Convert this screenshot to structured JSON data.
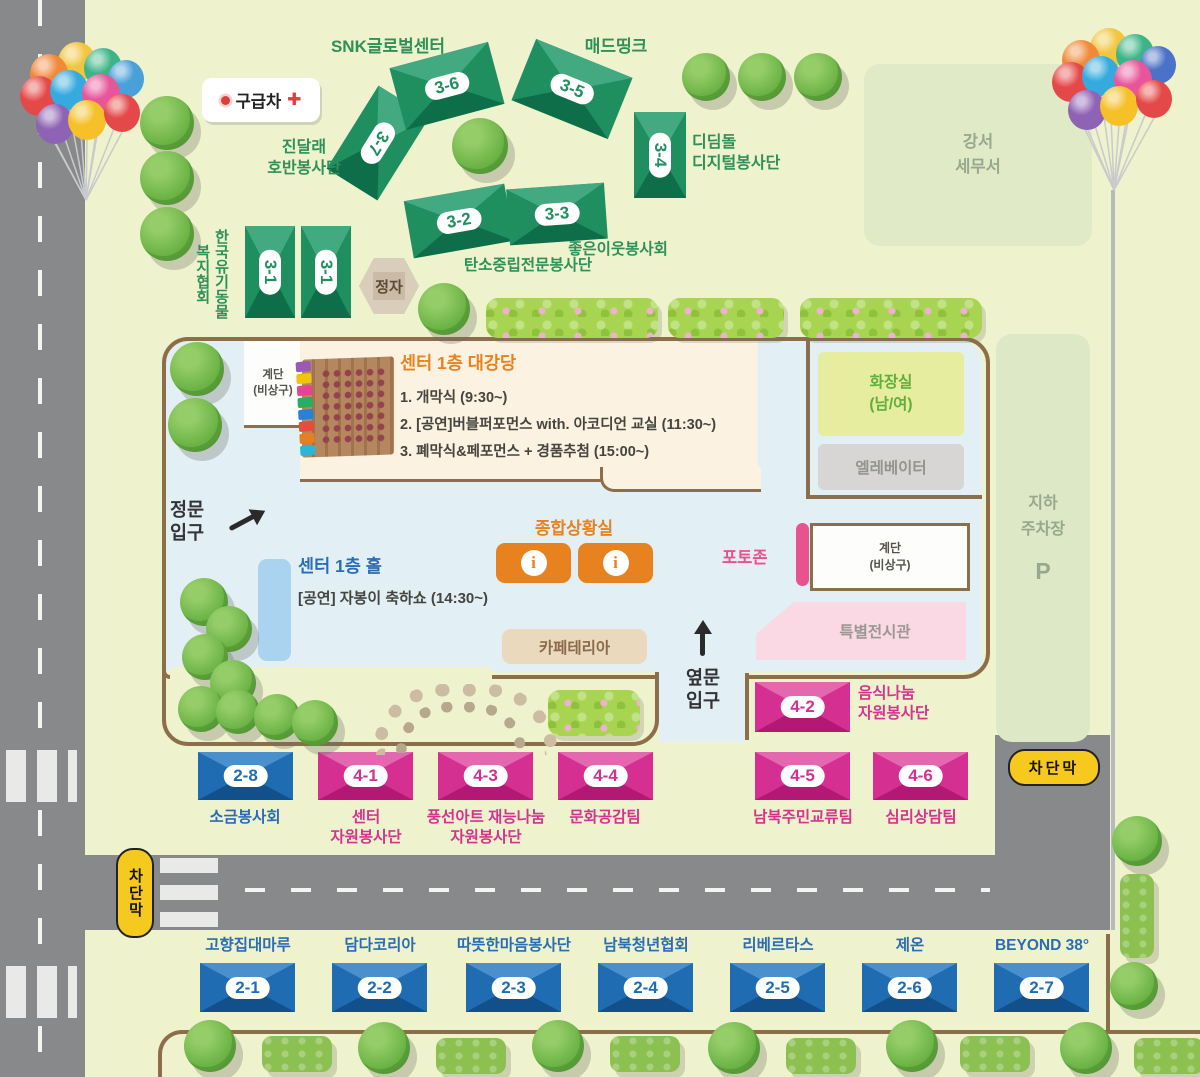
{
  "site": {
    "ambulance": "구급차",
    "ambulance_cross": "✚",
    "pavilion": "정자",
    "tax_office": "강서\n세무서",
    "parking_lines": "지하\n주차장",
    "parking_symbol": "P",
    "barrier": "차단막",
    "main_gate": "정문\n입구",
    "side_gate": "옆문\n입구"
  },
  "building": {
    "auditorium_title": "센터 1층 대강당",
    "schedule": [
      "1. 개막식 (9:30~)",
      "2. [공연]버블퍼포먼스 with. 아코디언 교실 (11:30~)",
      "3. 폐막식&페포먼스 + 경품추첨 (15:00~)"
    ],
    "hall_title": "센터 1층 홀",
    "hall_event": "[공연] 자봉이 축하쇼 (14:30~)",
    "info_center": "종합상황실",
    "info_i": "i",
    "restroom": "화장실\n(남/여)",
    "elevator": "엘레베이터",
    "stairs": "계단\n(비상구)",
    "photo_zone": "포토존",
    "special_exhibition": "특별전시관",
    "cafeteria": "카페테리아"
  },
  "booths": {
    "g31a": {
      "num": "3-1"
    },
    "g31b": {
      "num": "3-1"
    },
    "g31_label": "한국유기동물\n복지협회",
    "g32": {
      "num": "3-2",
      "label": "탄소중립전문봉사단"
    },
    "g33": {
      "num": "3-3",
      "label": "좋은이웃봉사회"
    },
    "g34": {
      "num": "3-4",
      "label": "디딤돌\n디지털봉사단"
    },
    "g35": {
      "num": "3-5",
      "label": "매드띵크"
    },
    "g36": {
      "num": "3-6",
      "label": "SNK글로벌센터"
    },
    "g37": {
      "num": "3-7",
      "label": "진달래\n호반봉사단"
    },
    "p41": {
      "num": "4-1",
      "label": "센터\n자원봉사단"
    },
    "p42": {
      "num": "4-2",
      "label": "음식나눔\n자원봉사단"
    },
    "p43": {
      "num": "4-3",
      "label": "풍선아트 재능나눔\n자원봉사단"
    },
    "p44": {
      "num": "4-4",
      "label": "문화공감팀"
    },
    "p45": {
      "num": "4-5",
      "label": "남북주민교류팀"
    },
    "p46": {
      "num": "4-6",
      "label": "심리상담팀"
    },
    "b21": {
      "num": "2-1",
      "label": "고향집대마루"
    },
    "b22": {
      "num": "2-2",
      "label": "담다코리아"
    },
    "b23": {
      "num": "2-3",
      "label": "따뜻한마음봉사단"
    },
    "b24": {
      "num": "2-4",
      "label": "남북청년협회"
    },
    "b25": {
      "num": "2-5",
      "label": "리베르타스"
    },
    "b26": {
      "num": "2-6",
      "label": "제온"
    },
    "b27": {
      "num": "2-7",
      "label": "BEYOND 38°"
    },
    "b28": {
      "num": "2-8",
      "label": "소금봉사회"
    }
  },
  "colors": {
    "green_booth": "#1f8f60",
    "pink_booth": "#d62f92",
    "blue_booth": "#1f6cb2",
    "accent_orange": "#e8821e",
    "photo_pink": "#e8538f",
    "barrier_yellow": "#f6c91e"
  }
}
